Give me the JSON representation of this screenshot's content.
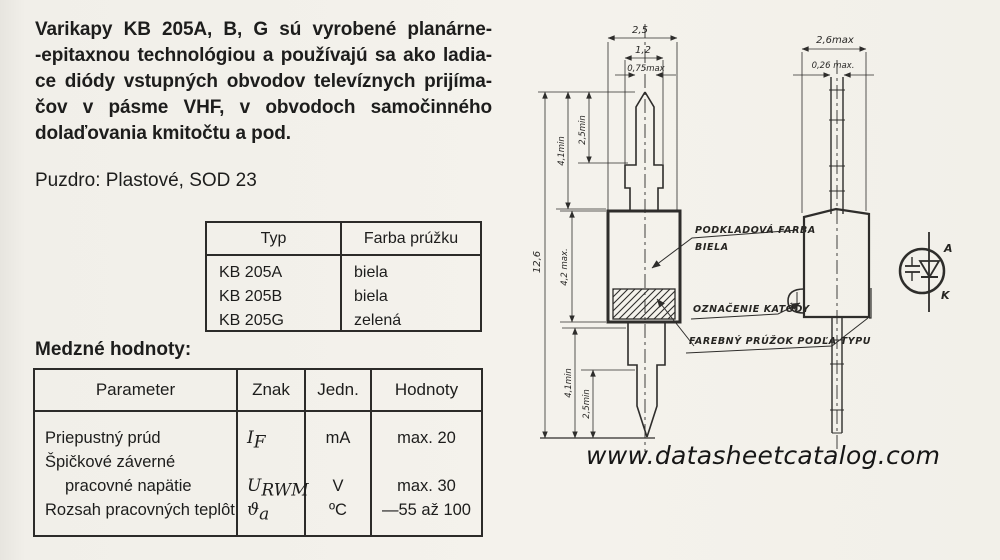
{
  "intro": {
    "lines": [
      "Varikapy KB 205A, B, G sú vyrobené planárne-",
      "-epitaxnou technológiou a používajú sa ako ladia-",
      "ce diódy vstupných obvodov televíznych prijíma-",
      "čov v pásme VHF, v obvodoch samočinného",
      "dolaďovania kmitočtu a pod."
    ],
    "package": "Puzdro: Plastové, SOD 23"
  },
  "type_table": {
    "col_type": "Typ",
    "col_color": "Farba prúžku",
    "rows": [
      {
        "type": "KB 205A",
        "color": "biela"
      },
      {
        "type": "KB 205B",
        "color": "biela"
      },
      {
        "type": "KB 205G",
        "color": "zelená"
      }
    ]
  },
  "limits_table": {
    "heading": "Medzné hodnoty:",
    "headers": [
      "Parameter",
      "Znak",
      "Jedn.",
      "Hodnoty"
    ],
    "rows": [
      {
        "parameter": "Priepustný prúd",
        "symbol": "I",
        "symbol_sub": "F",
        "unit": "mA",
        "value": "max. 20"
      },
      {
        "parameter": "Špičkové záverné",
        "symbol": "",
        "symbol_sub": "",
        "unit": "",
        "value": ""
      },
      {
        "parameter": "pracovné napätie",
        "symbol": "U",
        "symbol_sub": "RWM",
        "unit": "V",
        "value": "max. 30"
      },
      {
        "parameter": "Rozsah pracovných teplôt",
        "symbol": "ϑ",
        "symbol_sub": "a",
        "unit": "ºC",
        "value": "—55 až 100"
      }
    ]
  },
  "drawing": {
    "front": {
      "body_width": "2,5",
      "flange_width": "1,2",
      "lead_width": "0,75max",
      "total_length": "12,6",
      "lead_top": "4,1min",
      "tip_top": "2,5min",
      "body_length": "4,2 max.",
      "lead_bottom": "4,1min",
      "tip_bottom": "2,5min"
    },
    "side": {
      "body_width": "2,6max",
      "lead_thickness": "0,26 max."
    },
    "callouts": {
      "base_color_line1": "PODKLADOVÁ FARBA",
      "base_color_line2": "BIELA",
      "cathode_mark": "OZNAČENIE KATÓDY",
      "color_stripe": "FAREBNÝ PRÚŽOK PODĽA TYPU"
    },
    "symbol": {
      "anode": "A",
      "cathode": "K"
    }
  },
  "page": {
    "watermark": "www.datasheetcatalog.com"
  }
}
